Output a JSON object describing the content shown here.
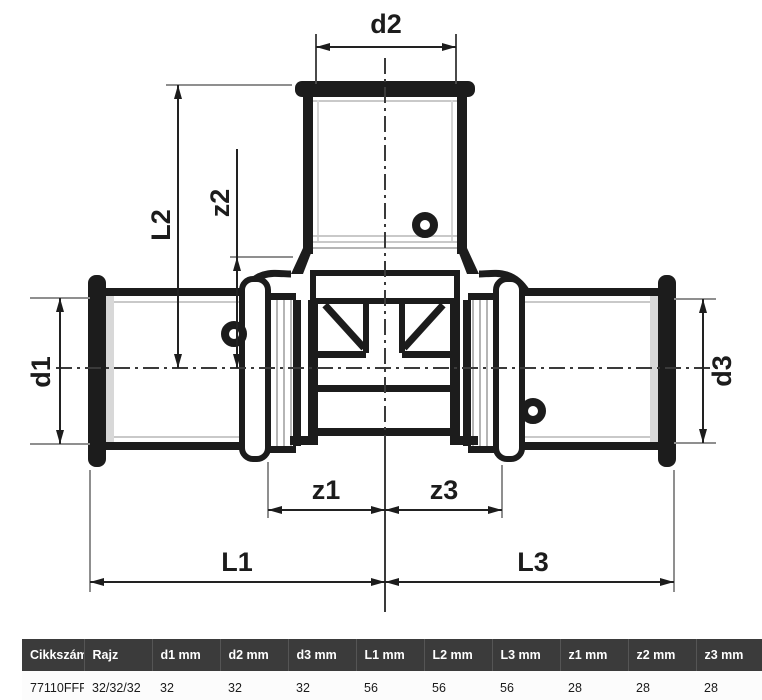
{
  "drawing": {
    "labels": {
      "d1": "d1",
      "d2": "d2",
      "d3": "d3",
      "L1": "L1",
      "L2": "L2",
      "L3": "L3",
      "z1": "z1",
      "z2": "z2",
      "z3": "z3"
    }
  },
  "table": {
    "headers": [
      "Cikkszám",
      "Rajz",
      "d1 mm",
      "d2 mm",
      "d3 mm",
      "L1 mm",
      "L2 mm",
      "L3 mm",
      "z1 mm",
      "z2 mm",
      "z3 mm"
    ],
    "rows": [
      [
        "77110FFF",
        "32/32/32",
        "32",
        "32",
        "32",
        "56",
        "56",
        "56",
        "28",
        "28",
        "28"
      ]
    ]
  },
  "colors": {
    "outline": "#1c1c1c",
    "extension_line": "#8f8f8f",
    "centerline": "#3a3a3a",
    "header_bg": "#3b3b3b",
    "header_text": "#ffffff",
    "row_bg": "#fcfcfc",
    "row_text": "#1a1a1a"
  }
}
